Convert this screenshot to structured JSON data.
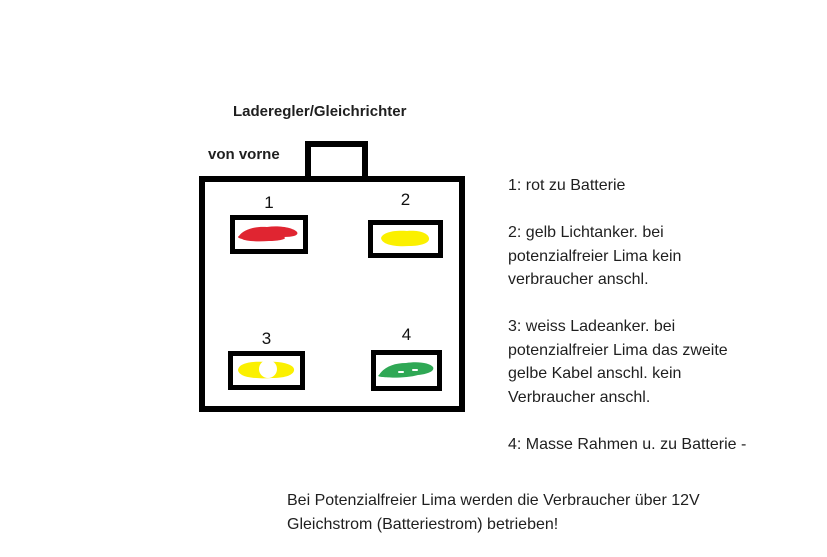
{
  "title": "Laderegler/Gleichrichter",
  "view_label": "von vorne",
  "connector": {
    "slots": [
      {
        "number": "1",
        "wire": "rot",
        "color": "#e02531"
      },
      {
        "number": "2",
        "wire": "gelb",
        "color": "#fbf000"
      },
      {
        "number": "3",
        "wire": "weiss",
        "color": "#fbf000",
        "center_color": "#ffffff"
      },
      {
        "number": "4",
        "wire": "masse",
        "color": "#2fa855"
      }
    ]
  },
  "legend": {
    "items": [
      {
        "lines": [
          "1: rot zu Batterie"
        ]
      },
      {
        "lines": [
          "2: gelb Lichtanker. bei",
          "potenzialfreier Lima kein",
          "verbraucher anschl."
        ]
      },
      {
        "lines": [
          "3: weiss Ladeanker. bei",
          "potenzialfreier Lima das zweite",
          "gelbe Kabel anschl. kein",
          "Verbraucher anschl."
        ]
      },
      {
        "lines": [
          "4: Masse Rahmen u. zu Batterie -"
        ]
      }
    ]
  },
  "footer": {
    "lines": [
      "Bei Potenzialfreier Lima werden die Verbraucher über 12V",
      "Gleichstrom (Batteriestrom) betrieben!"
    ]
  }
}
